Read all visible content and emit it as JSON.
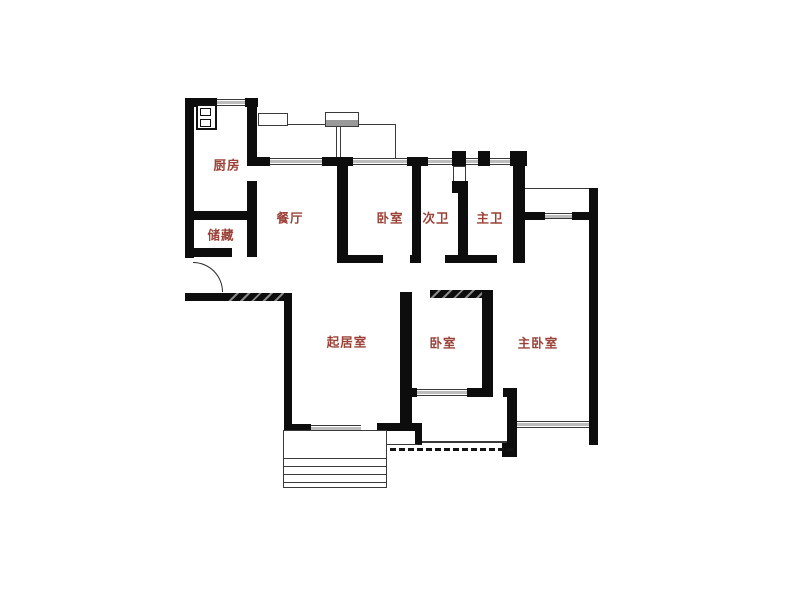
{
  "page": {
    "background_color": "#ffffff",
    "content_type": "apartment floor plan drawing"
  },
  "floor_plan": {
    "wall_color": "#0d0d0d",
    "label_color": "#9b4238",
    "window_glass_color": "#bdbdbd",
    "rooms": [
      {
        "id": "kitchen",
        "label": "厨房"
      },
      {
        "id": "storage",
        "label": "储藏"
      },
      {
        "id": "dining",
        "label": "餐厅"
      },
      {
        "id": "bedroom-north",
        "label": "卧室"
      },
      {
        "id": "bath-second",
        "label": "次卫"
      },
      {
        "id": "bath-master",
        "label": "主卫"
      },
      {
        "id": "living-room",
        "label": "起居室"
      },
      {
        "id": "bedroom-middle",
        "label": "卧室"
      },
      {
        "id": "bedroom-master",
        "label": "主卧室"
      }
    ]
  }
}
